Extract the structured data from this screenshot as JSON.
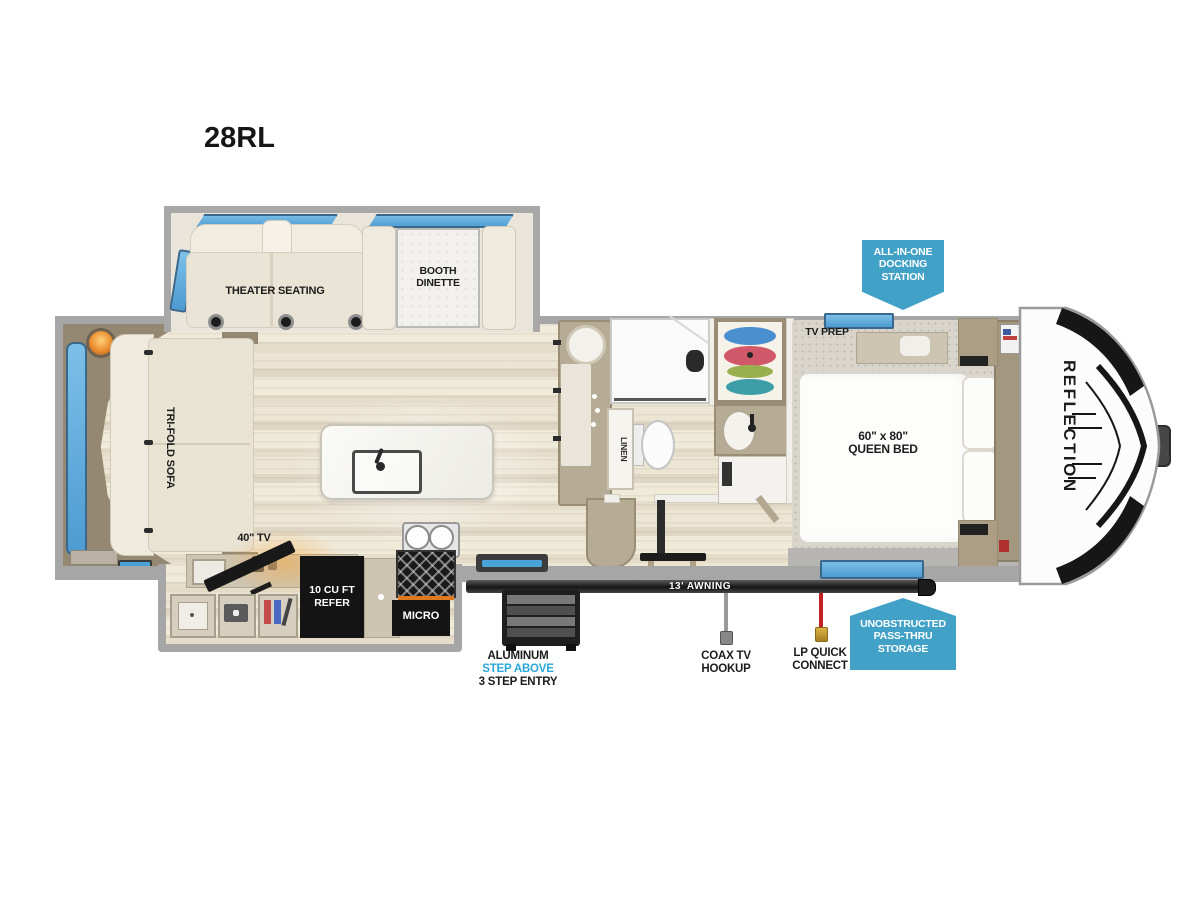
{
  "title": "28RL",
  "brand": "REFLECTION",
  "labels": {
    "theater_seating": "THEATER SEATING",
    "booth_dinette": [
      "BOOTH",
      "DINETTE"
    ],
    "trifold_sofa": "TRI-FOLD SOFA",
    "tv": "40\" TV",
    "refer": [
      "10 CU FT",
      "REFER"
    ],
    "micro": "MICRO",
    "linen": "LINEN",
    "tv_prep": "TV PREP",
    "queen_bed": [
      "60\" x 80\"",
      "QUEEN BED"
    ],
    "awning": "13' AWNING"
  },
  "callouts": {
    "docking_station": [
      "ALL-IN-ONE",
      "DOCKING",
      "STATION"
    ],
    "pass_thru": [
      "UNOBSTRUCTED",
      "PASS-THRU",
      "STORAGE"
    ],
    "entry_steps": [
      "ALUMINUM",
      "STEP ABOVE",
      "3 STEP ENTRY"
    ],
    "coax": [
      "COAX TV",
      "HOOKUP"
    ],
    "lp": [
      "LP QUICK",
      "CONNECT"
    ]
  },
  "colors": {
    "callout_blue": "#42a1c7",
    "step_above_blue": "#2aa7d9",
    "window_blue": "#57a8da",
    "wall_gray": "#a6a6a6",
    "appliance_black": "#141414",
    "floor_cream": "#ece5d4",
    "cabinet_tan": "#958872",
    "awning_dark": "#2b2b2b",
    "fireplace_orange": "#e89035"
  }
}
